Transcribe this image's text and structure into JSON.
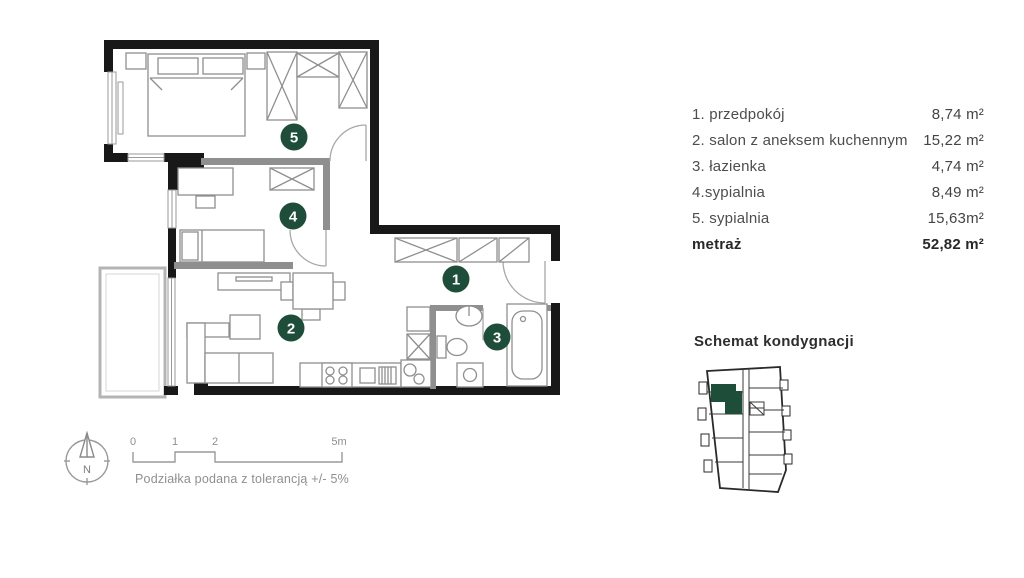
{
  "palette": {
    "accent_green": "#1e4e3a",
    "wall_black": "#181818",
    "partition_gray": "#8f8f8f"
  },
  "legend": {
    "rows": [
      {
        "label": "1. przedpokój",
        "value": "8,74 m²"
      },
      {
        "label": "2. salon z aneksem kuchennym",
        "value": "15,22 m²"
      },
      {
        "label": "3. łazienka",
        "value": "4,74 m²"
      },
      {
        "label": "4.sypialnia",
        "value": "8,49 m²"
      },
      {
        "label": "5. sypialnia",
        "value": "15,63m²"
      }
    ],
    "total_label": "metraż",
    "total_value": "52,82 m²"
  },
  "plan": {
    "room_badges": [
      {
        "number": "1"
      },
      {
        "number": "2"
      },
      {
        "number": "3"
      },
      {
        "number": "4"
      },
      {
        "number": "5"
      }
    ]
  },
  "floor_schematic": {
    "title": "Schemat kondygnacji"
  },
  "scale_bar": {
    "ticks": {
      "t0": "0",
      "t1": "1",
      "t2": "2",
      "t5": "5m"
    },
    "note": "Podziałka podana z tolerancją +/- 5%"
  },
  "compass": {
    "north": "N"
  }
}
